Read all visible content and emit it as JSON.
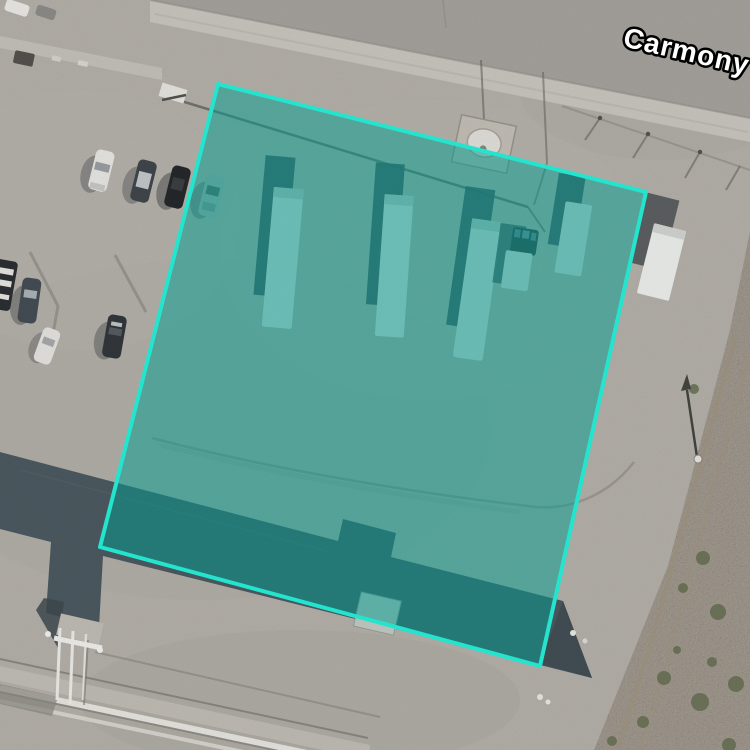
{
  "map": {
    "imagery": "satellite",
    "street_label": "Carmony",
    "selection": {
      "points": "218,84 646,192 540,666 100,547",
      "stroke_color": "#25e4ce",
      "stroke_width": 4,
      "fill_color": "#009e92",
      "fill_opacity": 0.5
    },
    "palette": {
      "ground": "#b6b2ab",
      "road": "#a7a39e",
      "sidewalk": "#cbc7c0",
      "roof": "#4d5a61",
      "dirt_strip": "#b2a593",
      "label_fill": "#ffffff",
      "label_outline": "#000000"
    }
  }
}
